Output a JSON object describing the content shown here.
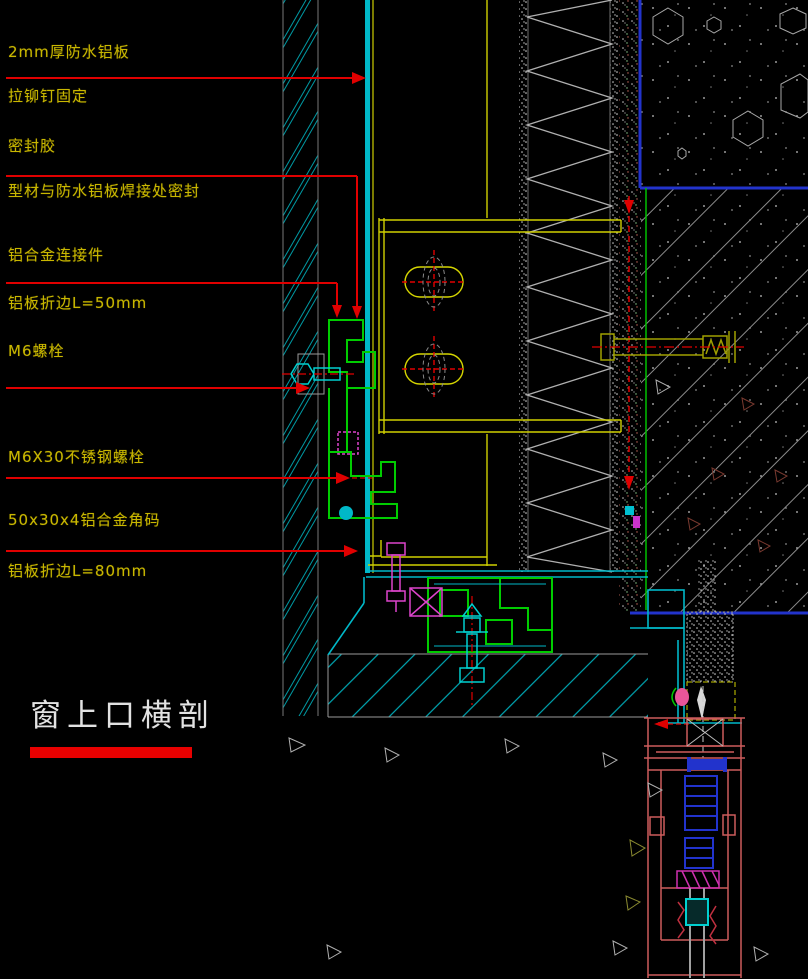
{
  "page": {
    "background": "#000000"
  },
  "annotations": {
    "color": "#c9b700",
    "leader_color": "#e00000",
    "items": [
      {
        "label": "2mm厚防水铝板"
      },
      {
        "label": "拉铆钉固定"
      },
      {
        "label": "密封胶"
      },
      {
        "label": "型材与防水铝板焊接处密封"
      },
      {
        "label": "铝合金连接件"
      },
      {
        "label": "铝板折边L=50mm"
      },
      {
        "label": "M6螺栓"
      },
      {
        "label": "M6X30不锈钢螺栓"
      },
      {
        "label": "50x30x4铝合金角码"
      },
      {
        "label": "铝板折边L=80mm"
      }
    ]
  },
  "title": {
    "text": "窗上口横剖",
    "color": "#e2e2e2",
    "underline_color": "#e80000"
  },
  "palette": {
    "panel_cyan": "#00b8c8",
    "profile_green": "#00cc00",
    "steel_yellow": "#cfcf00",
    "structure_blue": "#2233cc",
    "frame_salmon": "#cd5c5c",
    "fastener_magenta": "#dd44cc",
    "anchor_olive": "#a0a000",
    "hatch_gray": "#9a9a9a"
  }
}
